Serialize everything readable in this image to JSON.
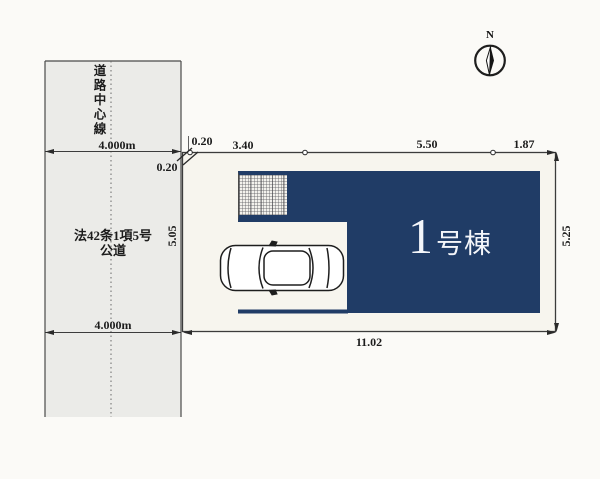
{
  "compass": {
    "north_label": "N"
  },
  "road": {
    "center_line_label": "道路中心線",
    "width_label_top": "4.000m",
    "width_label_bottom": "4.000m",
    "name_line1": "法42条1項5号",
    "name_line2": "公道"
  },
  "dimensions": {
    "offset_top": "0.20",
    "offset_left": "0.20",
    "top_1": "3.40",
    "top_2": "5.50",
    "top_3": "1.87",
    "left_side": "5.05",
    "right_side": "5.25",
    "bottom": "11.02"
  },
  "building": {
    "number": "1",
    "suffix": "号棟"
  },
  "colors": {
    "building_navy": "#203c66",
    "road_gray": "#ebebe8",
    "plot_bg": "#f7f5ee",
    "line_dark": "#3c3c3c"
  }
}
